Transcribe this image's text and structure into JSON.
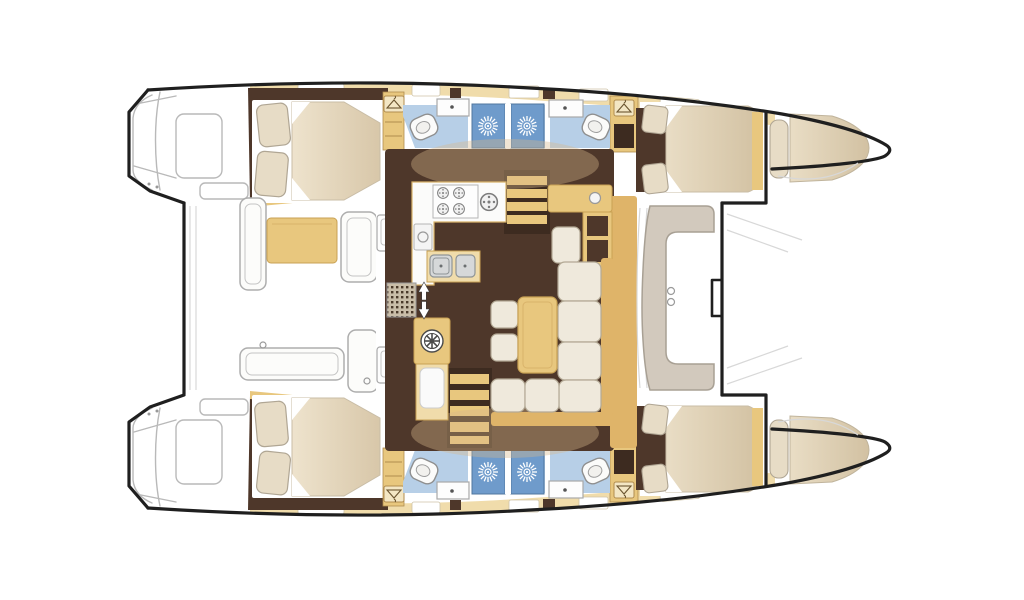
{
  "meta": {
    "type": "floorplan-diagram",
    "subject": "catamaran sailing yacht interior layout, top view, bow to the right",
    "aria_label": "Catamaran floor plan: four double cabins, four bathrooms with shower stalls, central salon with galley and dining sofa, aft cockpit with table, foredeck seat and bow trampoline",
    "visible_text": []
  },
  "palette": {
    "outline": "#1f1f1f",
    "sketch": "#b9b9b9",
    "sketch_light": "#d8d8d8",
    "floor_brown": "#4e372a",
    "floor_brown_dark": "#3d2b20",
    "wood_tan": "#e8c77e",
    "wood_tan_light": "#f0dcab",
    "wood_tan_deep": "#dfb469",
    "cream": "#e7dcc6",
    "cream_dark": "#d8c7a9",
    "cushion_white": "#efe9dc",
    "taupe": "#d2c9bd",
    "bath_blue": "#b7cfe7",
    "shower_blue": "#6f9bcb",
    "shower_blue_dark": "#50779f",
    "white": "#ffffff"
  },
  "areas": {
    "port_hull": {
      "aft_cabin": {
        "name": "aft double cabin",
        "features": [
          "double berth",
          "2 pillows",
          "wardrobe"
        ]
      },
      "heads": {
        "name": "bathroom block",
        "features": [
          "toilet x2",
          "sink x2",
          "shower stall x2"
        ]
      },
      "forward_cabin": {
        "name": "forward double cabin",
        "features": [
          "double berth",
          "2 pillows"
        ]
      },
      "forepeak": {
        "name": "forepeak berth",
        "features": [
          "single berth",
          "bolster pillow"
        ]
      },
      "transom": {
        "name": "transom steps",
        "features": [
          "swim steps sketch"
        ]
      }
    },
    "starboard_hull": {
      "aft_cabin": {
        "name": "aft double cabin",
        "features": [
          "double berth",
          "2 pillows",
          "wardrobe"
        ]
      },
      "heads": {
        "name": "bathroom block",
        "features": [
          "toilet x2",
          "sink x2",
          "shower stall x2"
        ]
      },
      "forward_cabin": {
        "name": "forward double cabin",
        "features": [
          "double berth",
          "2 pillows"
        ]
      },
      "forepeak": {
        "name": "forepeak berth",
        "features": [
          "single berth",
          "bolster pillow"
        ]
      },
      "transom": {
        "name": "transom steps",
        "features": [
          "swim steps sketch"
        ]
      }
    },
    "salon": {
      "galley": {
        "features": [
          "4-burner stove",
          "auxiliary burner",
          "double sink",
          "oven"
        ]
      },
      "dining": {
        "features": [
          "L-shaped sofa",
          "coffee table",
          "2 ottomans"
        ]
      },
      "nav_station": {
        "features": [
          "chart desk",
          "seat",
          "instrument dial",
          "cabinet"
        ]
      },
      "helm_console": {
        "features": [
          "steering wheel",
          "cabinet"
        ]
      },
      "stairs": {
        "count": 2,
        "name": "companionway steps"
      },
      "vent_grille": {
        "name": "floor vent grille"
      },
      "direction_arrows": {
        "name": "up and down arrows"
      }
    },
    "aft_cockpit": {
      "features": [
        "cockpit table",
        "bench seating sketch",
        "transom door panels",
        "speakers"
      ]
    },
    "foredeck": {
      "features": [
        "C-shaped forward seat",
        "deck rings"
      ]
    },
    "trampoline": {
      "features": [
        "bow trampoline",
        "forward crossbeam",
        "anchor notch"
      ]
    }
  },
  "icons": [
    {
      "name": "shower-sunburst-icon",
      "count": 4
    },
    {
      "name": "wardrobe-hanger-icon",
      "count": 4
    },
    {
      "name": "helm-wheel-icon",
      "count": 1
    },
    {
      "name": "stove-burner-icon",
      "count": 5
    },
    {
      "name": "toilet-icon",
      "count": 4
    },
    {
      "name": "arrow-up-icon",
      "count": 1
    },
    {
      "name": "arrow-down-icon",
      "count": 1
    }
  ]
}
